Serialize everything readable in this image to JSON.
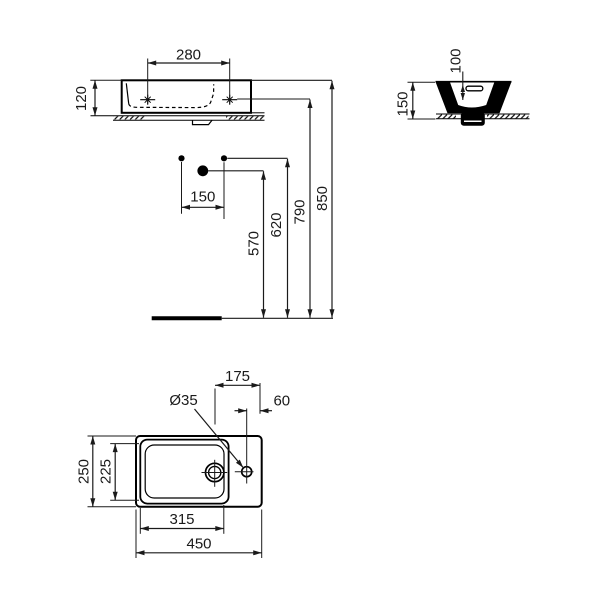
{
  "drawing": {
    "type": "sanitary-ware technical dimension drawing",
    "product": "wall-hung handrinse basin with right tap deck",
    "units": "mm",
    "colors": {
      "background": "#ffffff",
      "object_line": "#000000",
      "dimension_line": "#1a1a1a"
    },
    "views": {
      "front": {
        "name": "front elevation",
        "dimensions": {
          "fixing_hole_spacing_top": {
            "label": "280",
            "value_mm": 280,
            "meaning": "distance between fixing holes on the rim"
          },
          "body_height": {
            "label": "120",
            "value_mm": 120,
            "meaning": "height of basin body"
          }
        }
      },
      "side": {
        "name": "side section",
        "dimensions": {
          "rim_to_reference": {
            "label": "100",
            "value_mm": 100,
            "meaning": "depth below rim"
          },
          "total_depth_with_fixing": {
            "label": "150",
            "value_mm": 150,
            "meaning": "overall height of basin section"
          }
        }
      },
      "installation": {
        "name": "installation heights",
        "dimensions": {
          "wall_fixing_spacing": {
            "label": "150",
            "value_mm": 150,
            "meaning": "horizontal spacing of wall fixing points"
          },
          "trap_height": {
            "label": "570",
            "value_mm": 570,
            "meaning": "floor to waste outlet"
          },
          "bracket_height": {
            "label": "620",
            "value_mm": 620,
            "meaning": "floor to wall fixing points"
          },
          "hole_height": {
            "label": "790",
            "value_mm": 790,
            "meaning": "floor to rim fixing holes"
          },
          "rim_height": {
            "label": "850",
            "value_mm": 850,
            "meaning": "floor to basin rim"
          }
        }
      },
      "plan": {
        "name": "plan view",
        "dimensions": {
          "drain_to_right_edge": {
            "label": "175",
            "value_mm": 175,
            "meaning": "waste centre to right edge"
          },
          "taphole_to_right_edge": {
            "label": "60",
            "value_mm": 60,
            "meaning": "tap hole centre to right edge"
          },
          "taphole_diameter": {
            "label": "Ø35",
            "value_mm": 35,
            "meaning": "tap hole diameter"
          },
          "overall_depth": {
            "label": "250",
            "value_mm": 250,
            "meaning": "overall front-to-back depth"
          },
          "bowl_depth": {
            "label": "225",
            "value_mm": 225,
            "meaning": "bowl inner depth"
          },
          "bowl_width": {
            "label": "315",
            "value_mm": 315,
            "meaning": "bowl inner width"
          },
          "overall_width": {
            "label": "450",
            "value_mm": 450,
            "meaning": "overall width"
          }
        }
      }
    }
  }
}
